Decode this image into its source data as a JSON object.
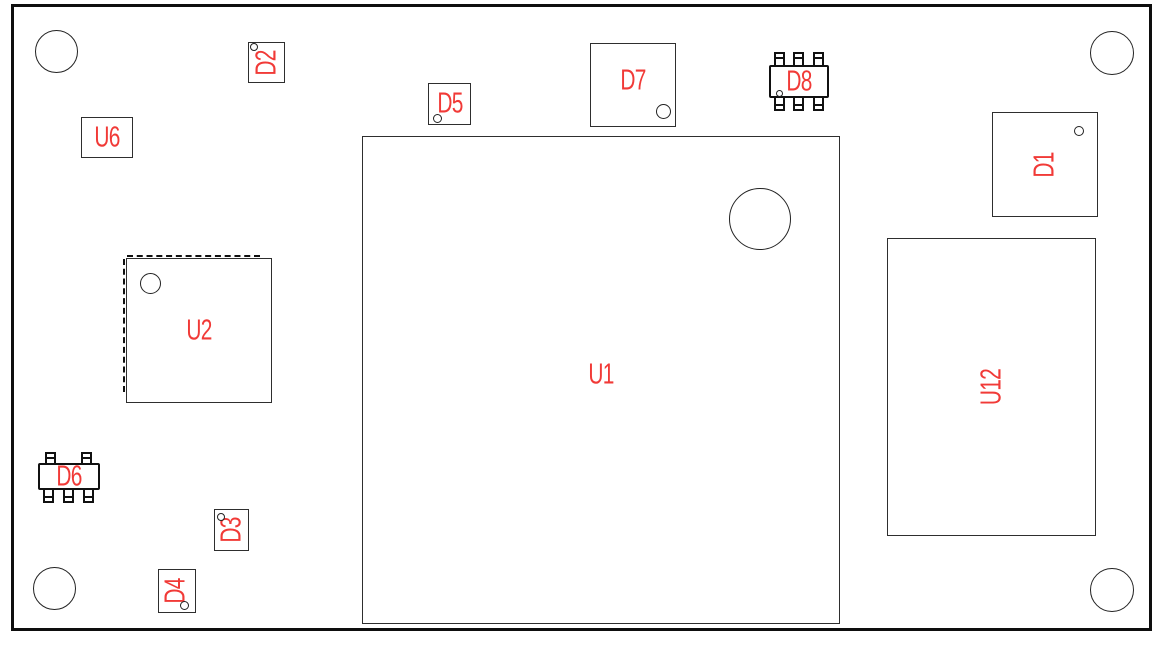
{
  "drawing": {
    "type": "pcb-assembly-top-view",
    "background_color": "#ffffff",
    "board_outline_color": "#0e0e0e",
    "component_outline_color": "#2e2e2e",
    "designator_color": "#f13a37",
    "mounting_hole_count": 4
  },
  "components": {
    "u1": {
      "label": "U1",
      "label_rotation": 0
    },
    "u2": {
      "label": "U2",
      "label_rotation": 0
    },
    "u6": {
      "label": "U6",
      "label_rotation": 0
    },
    "u12": {
      "label": "U12",
      "label_rotation": -90
    },
    "d1": {
      "label": "D1",
      "label_rotation": -90
    },
    "d2": {
      "label": "D2",
      "label_rotation": -90
    },
    "d3": {
      "label": "D3",
      "label_rotation": -90
    },
    "d4": {
      "label": "D4",
      "label_rotation": -90
    },
    "d5": {
      "label": "D5",
      "label_rotation": 0
    },
    "d6": {
      "label": "D6",
      "label_rotation": 0
    },
    "d7": {
      "label": "D7",
      "label_rotation": 0
    },
    "d8": {
      "label": "D8",
      "label_rotation": 0
    }
  }
}
